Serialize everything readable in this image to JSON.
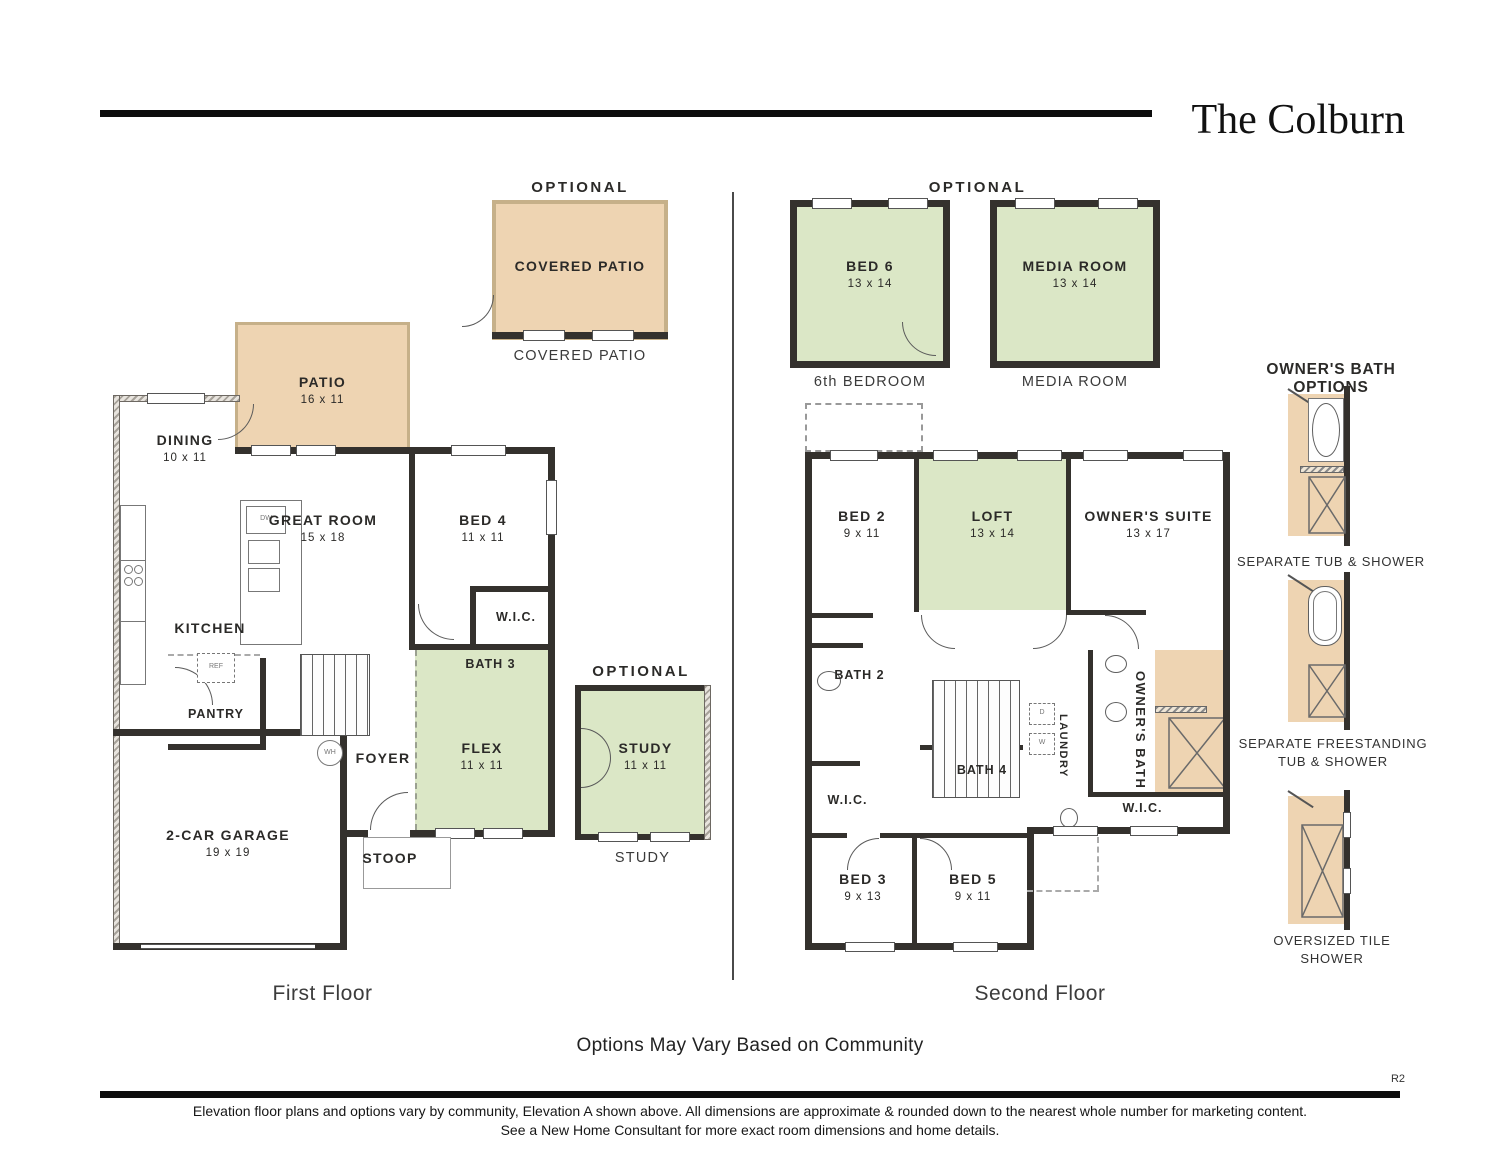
{
  "title": "The Colburn",
  "ff": {
    "caption": "First Floor",
    "optional_patio": {
      "header": "OPTIONAL",
      "label": "COVERED PATIO",
      "caption": "COVERED PATIO"
    },
    "optional_study": {
      "header": "OPTIONAL",
      "name": "STUDY",
      "dims": "11 x 11",
      "caption": "STUDY"
    },
    "rooms": {
      "patio": {
        "name": "PATIO",
        "dims": "16 x 11"
      },
      "dining": {
        "name": "DINING",
        "dims": "10 x 11"
      },
      "great": {
        "name": "GREAT ROOM",
        "dims": "15 x 18"
      },
      "bed4": {
        "name": "BED 4",
        "dims": "11 x 11"
      },
      "kitchen": {
        "name": "KITCHEN"
      },
      "wic": {
        "name": "W.I.C."
      },
      "bath3": {
        "name": "BATH 3"
      },
      "pantry": {
        "name": "PANTRY"
      },
      "foyer": {
        "name": "FOYER"
      },
      "flex": {
        "name": "FLEX",
        "dims": "11 x 11"
      },
      "garage": {
        "name": "2-CAR GARAGE",
        "dims": "19 x 19"
      },
      "stoop": {
        "name": "STOOP"
      }
    },
    "appliances": {
      "dw": "DW",
      "ref": "REF",
      "wh": "WH"
    }
  },
  "sf": {
    "caption": "Second Floor",
    "optional_header": "OPTIONAL",
    "optional_rooms": {
      "bed6": {
        "name": "BED 6",
        "dims": "13 x 14",
        "caption": "6th BEDROOM"
      },
      "media": {
        "name": "MEDIA ROOM",
        "dims": "13 x 14",
        "caption": "MEDIA ROOM"
      }
    },
    "rooms": {
      "bed2": {
        "name": "BED 2",
        "dims": "9 x 11"
      },
      "loft": {
        "name": "LOFT",
        "dims": "13 x 14"
      },
      "owners_suite": {
        "name": "OWNER'S SUITE",
        "dims": "13 x 17"
      },
      "bath2": {
        "name": "BATH 2"
      },
      "wic_left": {
        "name": "W.I.C."
      },
      "bath4": {
        "name": "BATH 4"
      },
      "laundry": {
        "name": "LAUNDRY"
      },
      "owners_bath": {
        "name": "OWNER'S BATH"
      },
      "wic_right": {
        "name": "W.I.C."
      },
      "bed3": {
        "name": "BED 3",
        "dims": "9 x 13"
      },
      "bed5": {
        "name": "BED 5",
        "dims": "9 x 11"
      }
    },
    "appliances": {
      "washer": "W",
      "dryer": "D"
    }
  },
  "bath_options": {
    "header": "OWNER'S BATH OPTIONS",
    "options": [
      {
        "caption": "SEPARATE TUB & SHOWER"
      },
      {
        "caption": "SEPARATE FREESTANDING TUB & SHOWER"
      },
      {
        "caption": "OVERSIZED TILE SHOWER"
      }
    ]
  },
  "footer": {
    "note": "Options May Vary Based on Community",
    "revision": "R2",
    "line1": "Elevation floor plans and options vary by community, Elevation A shown above. All dimensions are approximate & rounded down to the nearest whole number for marketing content.",
    "line2": "See a New Home Consultant for more exact room dimensions and home details."
  },
  "colors": {
    "tan": "#eed4b2",
    "green": "#dbe7c6",
    "wall": "#34312d"
  }
}
